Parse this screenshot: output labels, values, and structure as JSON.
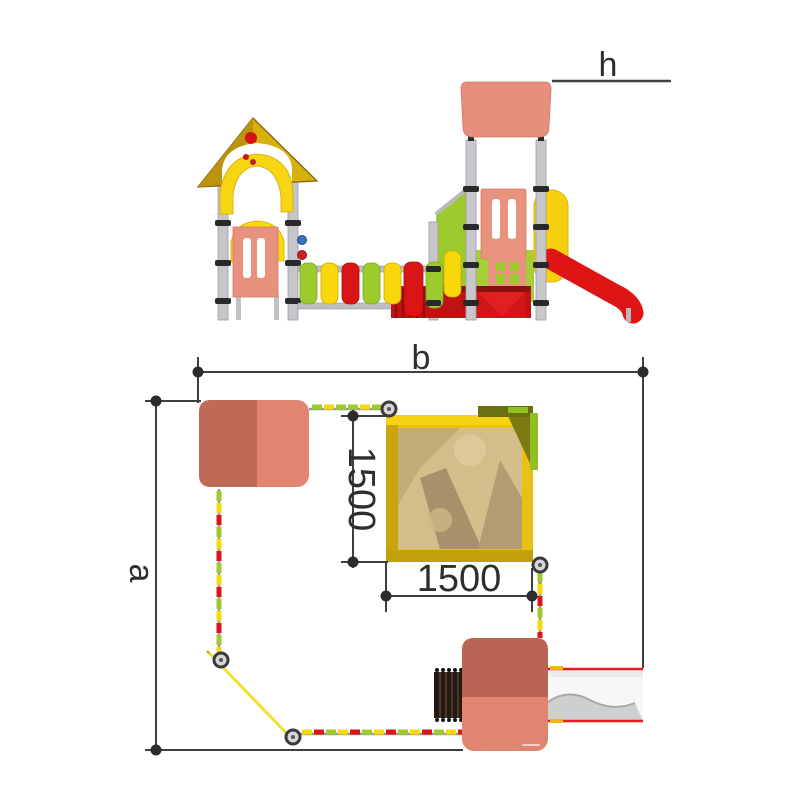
{
  "dimensions": {
    "height_label": "h",
    "overall_width_label": "b",
    "overall_depth_label": "a",
    "sandbox_depth_mm": "1500",
    "sandbox_width_mm": "1500"
  },
  "colors": {
    "roof_salmon_light": "#e28672",
    "roof_salmon_dark": "#bf6a57",
    "panel_salmon": "#e8937e",
    "roof_yellow": "#d9ae0e",
    "arch_yellow": "#f8d512",
    "slat_green": "#9dca2c",
    "slat_yellow": "#f8d80a",
    "slat_red": "#da1515",
    "slide_red": "#df1515",
    "sand": "#d3bd8b",
    "sandbox_frame_yellow": "#e8c115",
    "post_gray": "#c6c6ca",
    "dimension_line": "#3f3f3f"
  }
}
